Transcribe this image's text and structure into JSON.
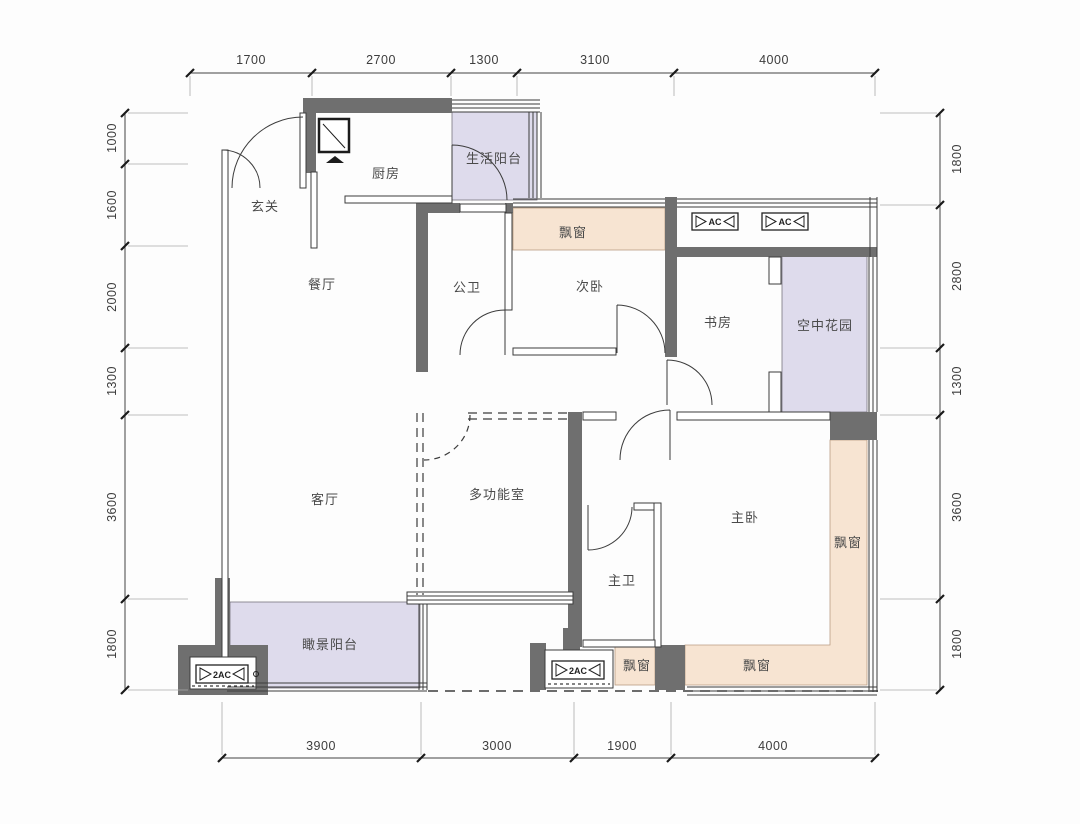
{
  "plan": {
    "type": "floor-plan",
    "rooms": {
      "entry": "玄关",
      "kitchen": "厨房",
      "service_balcony": "生活阳台",
      "dining": "餐厅",
      "guest_bath": "公卫",
      "second_bedroom": "次卧",
      "study": "书房",
      "sky_garden": "空中花园",
      "living": "客厅",
      "multi_room": "多功能室",
      "master_bedroom": "主卧",
      "master_bath": "主卫",
      "view_balcony": "瞰景阳台",
      "bay_window": "飘窗"
    },
    "equipment": {
      "ac": "AC",
      "ac2": "2AC"
    },
    "dimensions_mm": {
      "top": [
        "1700",
        "2700",
        "1300",
        "3100",
        "4000"
      ],
      "bottom": [
        "3900",
        "3000",
        "1900",
        "4000"
      ],
      "left": [
        "1000",
        "1600",
        "2000",
        "1300",
        "3600",
        "1800"
      ],
      "right": [
        "1800",
        "2800",
        "1300",
        "3600",
        "1800"
      ]
    },
    "colors": {
      "wall": "#6f6f6f",
      "balcony_fill": "#dedbec",
      "bay_window_fill": "#f7e4d2",
      "line": "#3c3c3c",
      "text": "#4a4a4a"
    }
  }
}
